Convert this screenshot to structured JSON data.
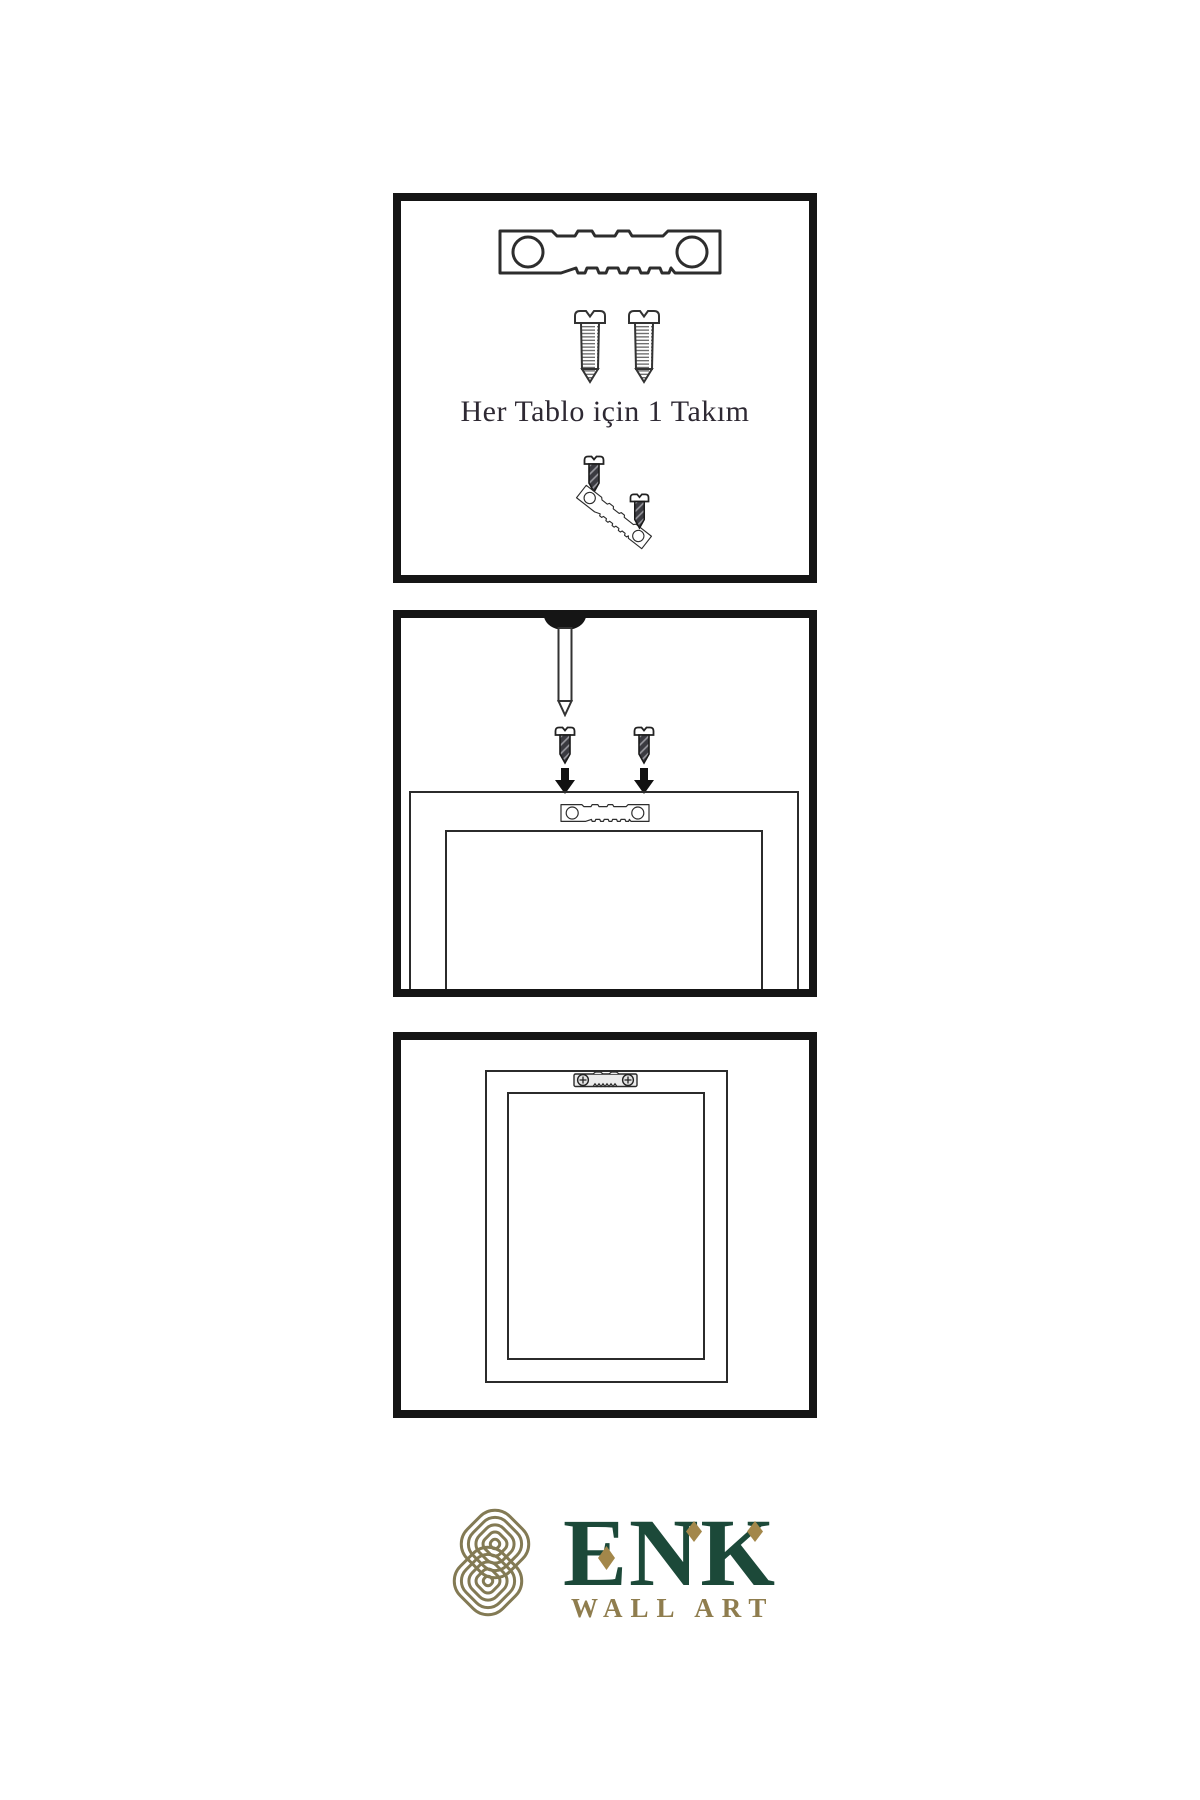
{
  "page": {
    "background": "#ffffff"
  },
  "instructions": {
    "step1": {
      "caption": "Her Tablo için 1 Takım",
      "icons": [
        "sawtooth-hanger-icon",
        "screw-icon",
        "screw-icon",
        "small-screw-icon",
        "tilted-hanger-icon",
        "small-screw-icon"
      ]
    },
    "step2": {
      "icons": [
        "nail-icon",
        "dark-screw-icon",
        "dark-screw-icon",
        "arrow-down-icon",
        "arrow-down-icon",
        "sawtooth-hanger-icon",
        "picture-frame"
      ]
    },
    "step3": {
      "icons": [
        "picture-frame",
        "mounted-hanger-icon"
      ]
    }
  },
  "logo": {
    "brand": "ENK",
    "tagline": "WALL ART",
    "icon": "knot-icon",
    "colors": {
      "brand_green": "#1c4939",
      "accent_gold": "#a3874a",
      "knot_gold": "#837a54",
      "tagline_gold": "#8f7d4e"
    }
  }
}
